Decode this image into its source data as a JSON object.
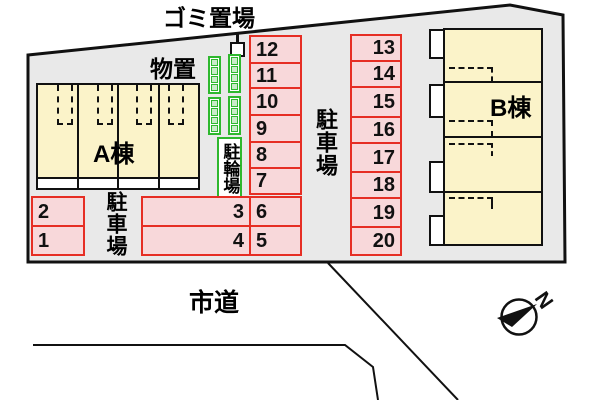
{
  "labels": {
    "garbage_area": "ゴミ置場",
    "storage": "物置",
    "bicycle_parking": "駐輪場",
    "parking_lot_left": "駐車場",
    "parking_lot_right": "駐車場",
    "city_road": "市道",
    "building_a": "A棟",
    "building_b": "B棟",
    "north": "N"
  },
  "spaces": {
    "left": [
      "2",
      "1"
    ],
    "wide": [
      "3",
      "4"
    ],
    "mid_upper": [
      "12",
      "11",
      "10",
      "9",
      "8",
      "7"
    ],
    "mid_lower": [
      "6",
      "5"
    ],
    "right": [
      "13",
      "14",
      "15",
      "16",
      "17",
      "18",
      "19",
      "20"
    ]
  },
  "colors": {
    "site_fill": "#e9e9e9",
    "outline": "#111111",
    "building_fill": "#fbf3c9",
    "space_fill": "#f8d8da",
    "space_border": "#e62e24",
    "rack_green": "#2eb82e",
    "rack_cell_fill": "#c9eac9"
  }
}
